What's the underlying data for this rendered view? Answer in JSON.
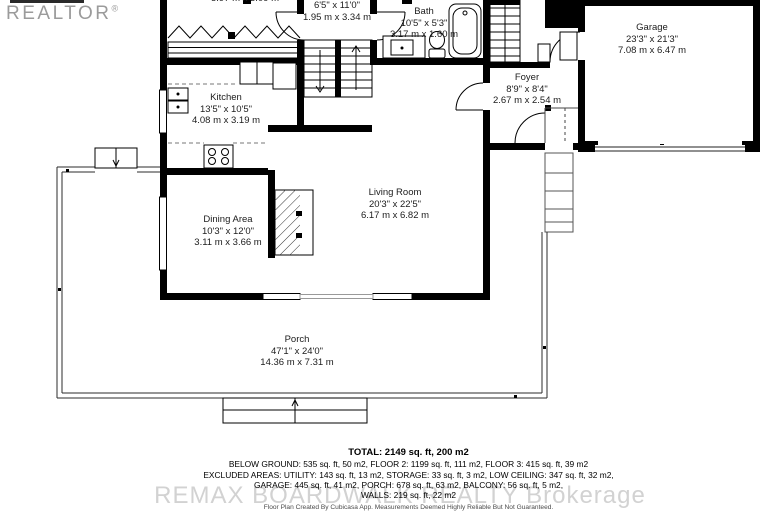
{
  "branding": {
    "realtor_watermark": "REALTOR",
    "realtor_reg": "®",
    "brokerage_watermark": "REMAX BOARDWALK REALTY Brokerage"
  },
  "rooms": {
    "upper": {
      "metric": "5.97 m x 3.09 m"
    },
    "hall": {
      "imperial": "6'5\" x 11'0\"",
      "metric": "1.95 m x 3.34 m"
    },
    "bath": {
      "name": "Bath",
      "imperial": "10'5\" x 5'3\"",
      "metric": "3.17 m x 1.60 m"
    },
    "garage": {
      "name": "Garage",
      "imperial": "23'3\" x 21'3\"",
      "metric": "7.08 m x 6.47 m"
    },
    "foyer": {
      "name": "Foyer",
      "imperial": "8'9\" x 8'4\"",
      "metric": "2.67 m x 2.54 m"
    },
    "kitchen": {
      "name": "Kitchen",
      "imperial": "13'5\" x 10'5\"",
      "metric": "4.08 m x 3.19 m"
    },
    "living": {
      "name": "Living Room",
      "imperial": "20'3\" x 22'5\"",
      "metric": "6.17 m x 6.82 m"
    },
    "dining": {
      "name": "Dining Area",
      "imperial": "10'3\" x 12'0\"",
      "metric": "3.11 m x 3.66 m"
    },
    "porch": {
      "name": "Porch",
      "imperial": "47'1\" x 24'0\"",
      "metric": "14.36 m x 7.31 m"
    }
  },
  "summary": {
    "total": "TOTAL: 2149 sq. ft, 200 m2",
    "line2": "BELOW GROUND: 535 sq. ft, 50 m2, FLOOR 2: 1199 sq. ft, 111 m2, FLOOR 3: 415 sq. ft, 39 m2",
    "line3": "EXCLUDED AREAS: UTILITY: 143 sq. ft, 13 m2, STORAGE: 33 sq. ft, 3 m2, LOW CEILING: 347 sq. ft, 32 m2,",
    "line4": "GARAGE: 445 sq. ft, 41 m2, PORCH: 678 sq. ft, 63 m2, BALCONY: 56 sq. ft, 5 m2,",
    "line5": "WALLS: 219 sq. ft, 22 m2",
    "disclaimer": "Floor Plan Created By Cubicasa App. Measurements Deemed Highly Reliable But Not Guaranteed."
  },
  "colors": {
    "wall": "#000000",
    "window_frame": "#000000",
    "garage_door": "#909090",
    "watermark_gray": "#d2d2d2"
  }
}
